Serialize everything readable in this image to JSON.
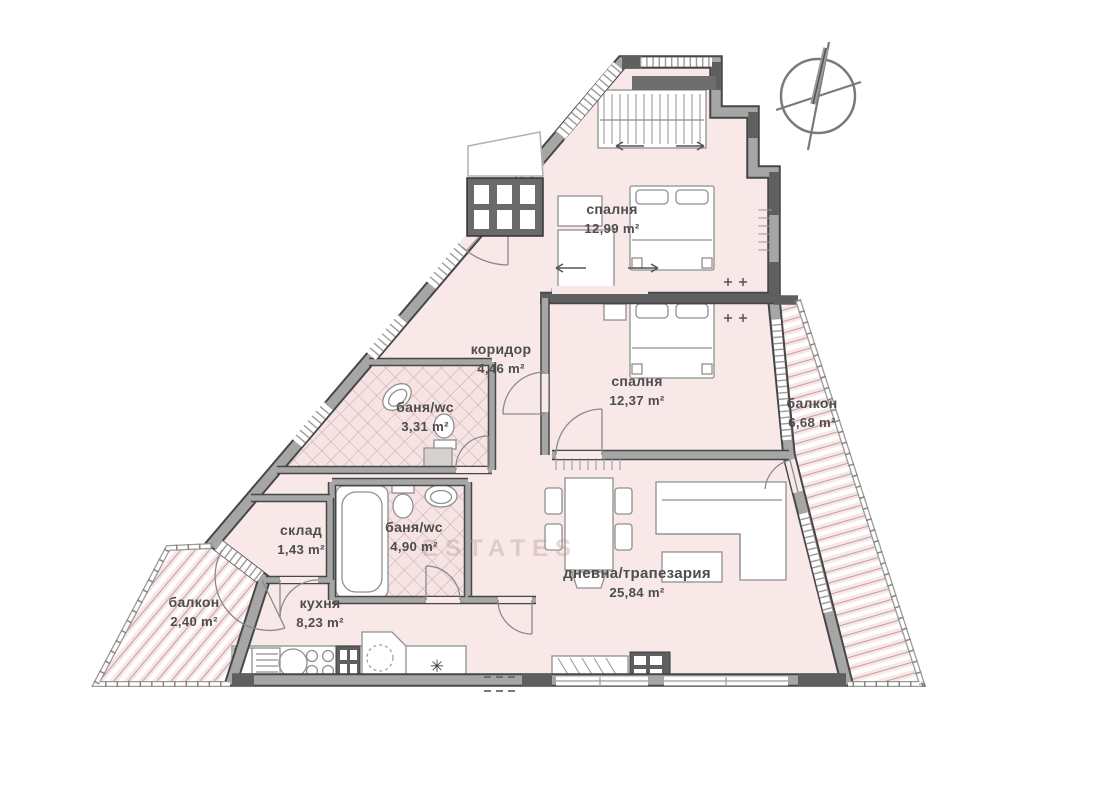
{
  "plan": {
    "rooms": [
      {
        "id": "bedroom-1",
        "label": "спалня",
        "area": "12,99 m²"
      },
      {
        "id": "bedroom-2",
        "label": "спалня",
        "area": "12,37 m²"
      },
      {
        "id": "corridor",
        "label": "коридор",
        "area": "4,46 m²"
      },
      {
        "id": "bathroom-1",
        "label": "баня/wc",
        "area": "3,31 m²"
      },
      {
        "id": "bathroom-2",
        "label": "баня/wc",
        "area": "4,90 m²"
      },
      {
        "id": "storage",
        "label": "склад",
        "area": "1,43 m²"
      },
      {
        "id": "kitchen",
        "label": "кухня",
        "area": "8,23 m²"
      },
      {
        "id": "living-dining",
        "label": "дневна/трапезария",
        "area": "25,84 m²"
      },
      {
        "id": "balcony-left",
        "label": "балкон",
        "area": "2,40 m²"
      },
      {
        "id": "balcony-right",
        "label": "балкон",
        "area": "6,68 m²"
      }
    ],
    "symbols": {
      "kitchen_star": "✳"
    },
    "watermark": "ESTATES",
    "colors": {
      "floor_fill": "#f8e8e8",
      "wall_gray": "#a6a6a6",
      "wall_dark": "#5f5f5f",
      "outline": "#474747",
      "label_text": "#4d4d4d",
      "balcony_stripe": "#c49e9e"
    }
  }
}
